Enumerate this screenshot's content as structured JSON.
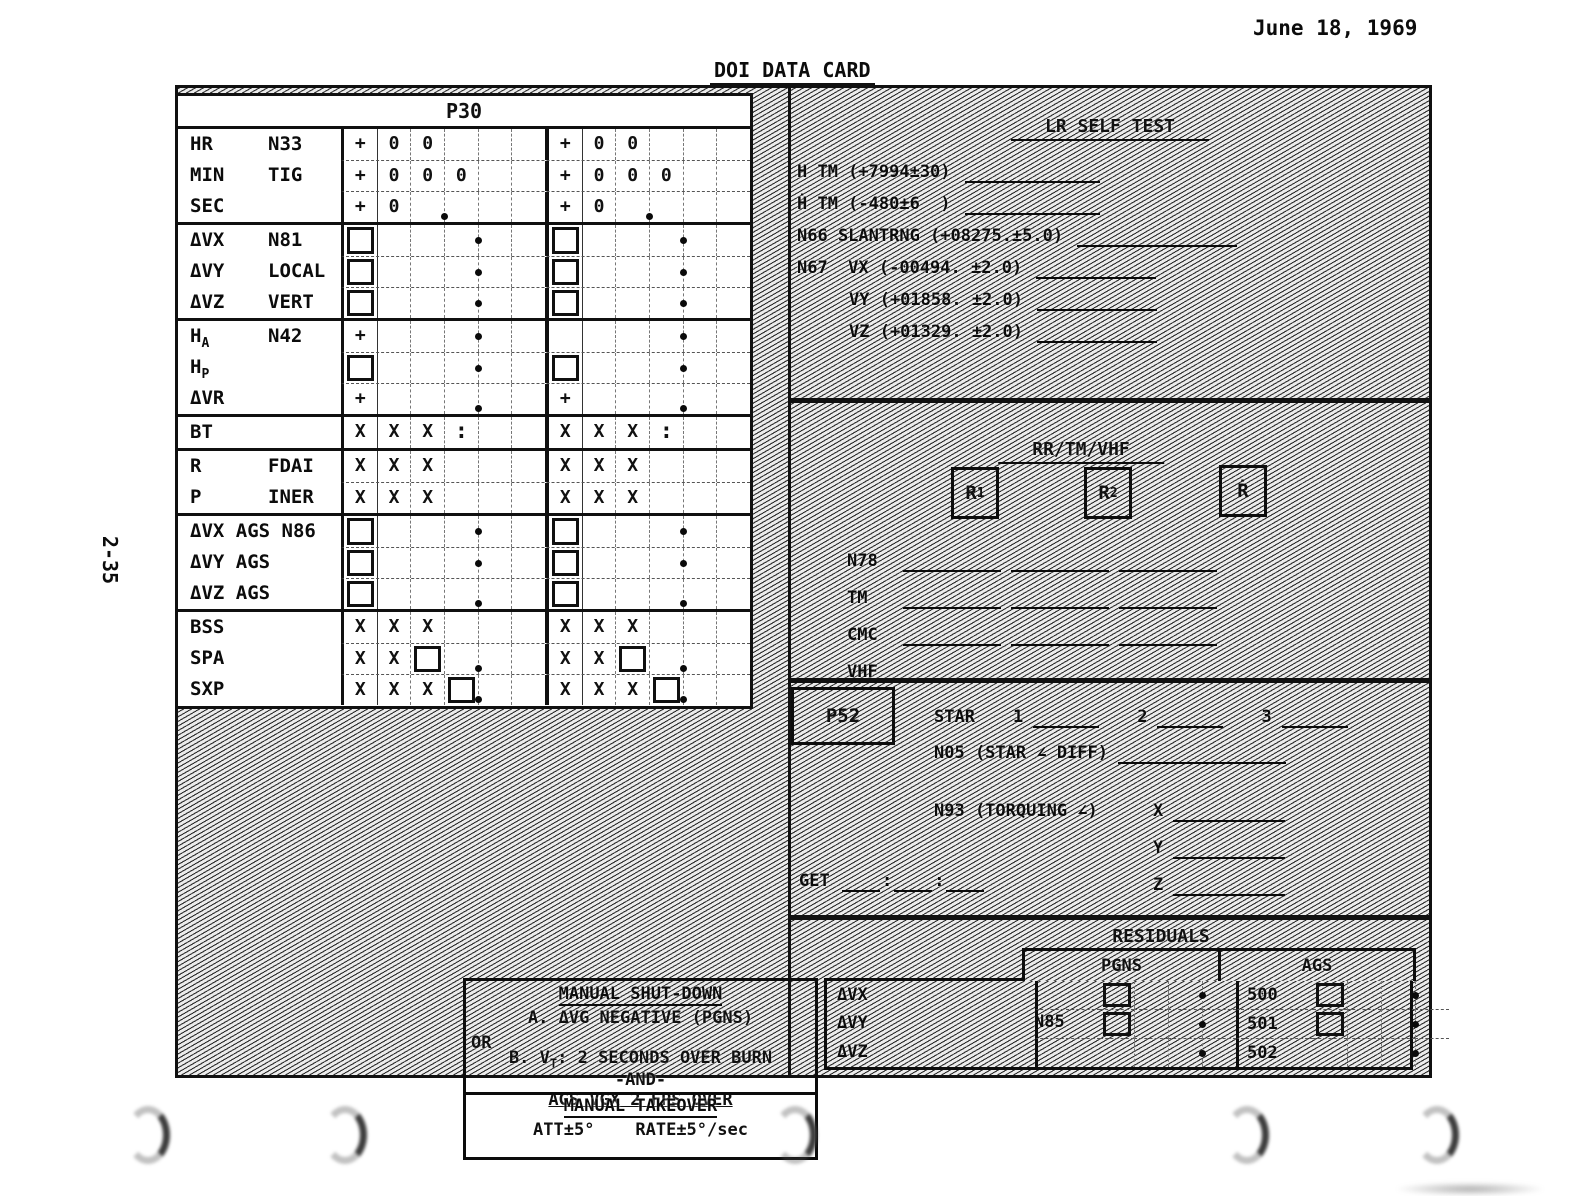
{
  "page": {
    "date": "June 18, 1969",
    "title": "DOI DATA CARD",
    "page_number": "2-35"
  },
  "p30": {
    "header": "P30",
    "blocks": [
      [
        {
          "l1": "HR",
          "l2": "N33",
          "c": [
            "+",
            "0",
            "0",
            "",
            "",
            ""
          ]
        },
        {
          "l1": "MIN",
          "l2": "TIG",
          "c": [
            "+",
            "0",
            "0",
            "0",
            "",
            ""
          ]
        },
        {
          "l1": "SEC",
          "l2": "",
          "c": [
            "+",
            "0",
            "",
            "b",
            "",
            ""
          ]
        }
      ],
      [
        {
          "l1": "ΔVX",
          "l2": "N81",
          "c": [
            "#",
            "",
            "",
            "",
            "d",
            ""
          ]
        },
        {
          "l1": "ΔVY",
          "l2": "LOCAL",
          "c": [
            "#",
            "",
            "",
            "",
            "d",
            ""
          ]
        },
        {
          "l1": "ΔVZ",
          "l2": "VERT",
          "c": [
            "#",
            "",
            "",
            "",
            "d",
            ""
          ]
        }
      ],
      [
        {
          "l1": "H",
          "l1sub": "A",
          "l2": "N42",
          "c": [
            "+",
            "",
            "",
            "",
            "d",
            ""
          ],
          "c2": [
            "",
            "",
            "",
            "",
            "d",
            ""
          ]
        },
        {
          "l1": "H",
          "l1sub": "P",
          "l2": "",
          "c": [
            "#",
            "",
            "",
            "",
            "d",
            ""
          ]
        },
        {
          "l1": "ΔVR",
          "l2": "",
          "c": [
            "+",
            "",
            "",
            "",
            "b",
            ""
          ]
        }
      ],
      [
        {
          "l1": "BT",
          "l2": "",
          "c": [
            "X",
            "X",
            "X",
            ":",
            "",
            ""
          ]
        }
      ],
      [
        {
          "l1": "R",
          "l2": "FDAI",
          "c": [
            "X",
            "X",
            "X",
            "",
            "",
            ""
          ]
        },
        {
          "l1": "P",
          "l2": "INER",
          "c": [
            "X",
            "X",
            "X",
            "",
            "",
            ""
          ]
        }
      ],
      [
        {
          "l1": "ΔVX AGS N86",
          "l2": "",
          "c": [
            "#",
            "",
            "",
            "",
            "d",
            ""
          ]
        },
        {
          "l1": "ΔVY AGS",
          "l2": "",
          "c": [
            "#",
            "",
            "",
            "",
            "d",
            ""
          ]
        },
        {
          "l1": "ΔVZ AGS",
          "l2": "",
          "c": [
            "#",
            "",
            "",
            "",
            "b",
            ""
          ]
        }
      ],
      [
        {
          "l1": "BSS",
          "l2": "",
          "c": [
            "X",
            "X",
            "X",
            "",
            "",
            ""
          ]
        },
        {
          "l1": "SPA",
          "l2": "",
          "c": [
            "X",
            "X",
            "#",
            "",
            "b",
            ""
          ]
        },
        {
          "l1": "SXP",
          "l2": "",
          "c": [
            "X",
            "X",
            "X",
            "#",
            "b",
            ""
          ]
        }
      ]
    ]
  },
  "lr_self_test": {
    "title": "LR SELF TEST",
    "rows": [
      {
        "label": "H TM (+7994±30)",
        "fill": 135,
        "indent": false
      },
      {
        "label": "Ḣ TM (-480±6  )",
        "fill": 135,
        "indent": false
      },
      {
        "label": "N66 SLANTRNG (+08275.±5.0)",
        "fill": 160,
        "indent": false
      },
      {
        "label": "N67  VX (-00494. ±2.0)",
        "fill": 120,
        "indent": false
      },
      {
        "label": "VY (+01858. ±2.0)",
        "fill": 120,
        "indent": true
      },
      {
        "label": "VZ (+01329. ±2.0)",
        "fill": 120,
        "indent": true
      }
    ]
  },
  "rr_tm_vhf": {
    "title": "RR/TM/VHF",
    "boxes": [
      {
        "main": "R",
        "sub": "1"
      },
      {
        "main": "R",
        "sub": "2"
      },
      {
        "main": "Ṙ",
        "sub": ""
      }
    ],
    "rows": [
      {
        "label": "N78",
        "segments": 3
      },
      {
        "label": "TM",
        "segments": 3
      },
      {
        "label": "CMC",
        "segments": 3
      },
      {
        "label": "VHF",
        "segments": 2
      }
    ]
  },
  "p52": {
    "box_label": "P52",
    "star_label": "STAR",
    "star_numbers": [
      "1",
      "2",
      "3"
    ],
    "n05_label": "N05 (STAR ∠ DIFF)",
    "n93_label": "N93 (TORQUING ∠)",
    "axes": [
      "X",
      "Y",
      "Z"
    ],
    "get_label": "GET",
    "get_separator": ":"
  },
  "residuals": {
    "title": "RESIDUALS",
    "pgns_header": "PGNS",
    "ags_header": "AGS",
    "row_labels": [
      "ΔVX",
      "ΔVY",
      "ΔVZ"
    ],
    "n85_label": "N85",
    "ags_codes": [
      "500",
      "501",
      "502"
    ]
  },
  "manual": {
    "title": "MANUAL SHUT-DOWN",
    "or_label": "OR",
    "item_a": "A. ΔVG NEGATIVE (PGNS)",
    "item_b_pre": "B. V",
    "item_b_sub": "T",
    "item_b_post": ": 2 SECONDS OVER BURN",
    "and_label": "-AND-",
    "ags_line": "AGS VGX 2 FPS OVER",
    "takeover_title": "MANUAL TAKEOVER",
    "takeover_values": "ATT±5°    RATE±5°/sec"
  },
  "colors": {
    "ink": "#111111",
    "paper": "#ffffff",
    "hatch_line": "#2e2e2e"
  }
}
